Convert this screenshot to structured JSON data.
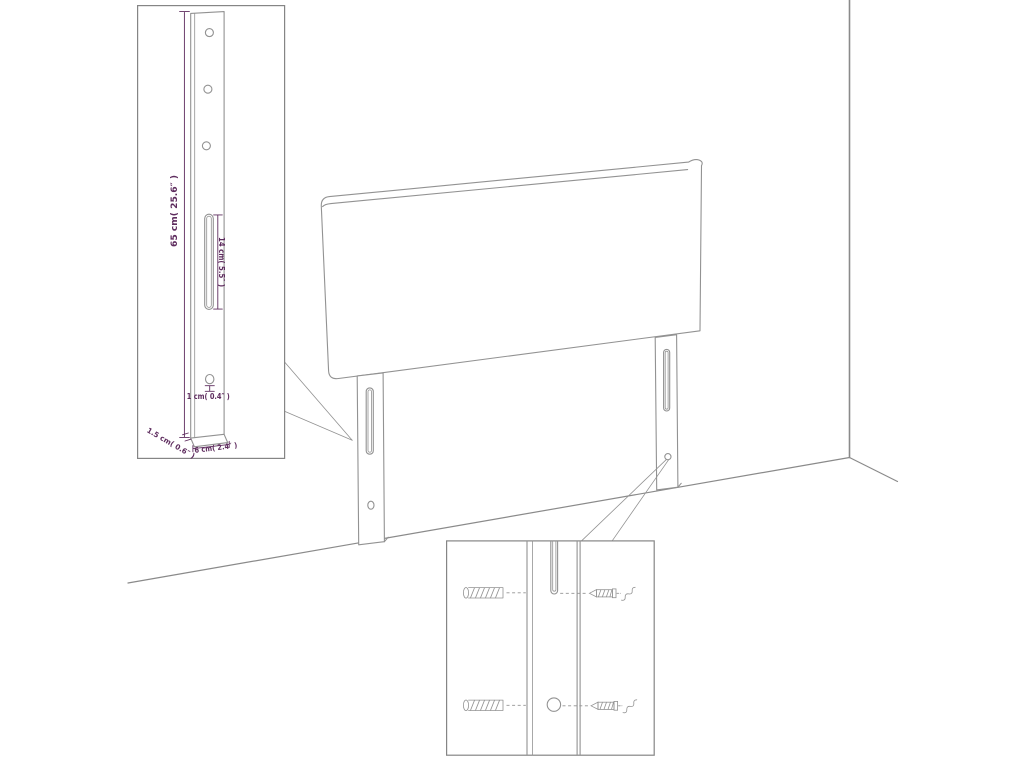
{
  "figure": {
    "type": "furniture-assembly-dimension-diagram"
  },
  "colors": {
    "line": "#929292",
    "corner": "#8a8a8a",
    "frame": "#858585",
    "dim": "#5e2c5e"
  },
  "labels": {
    "leg_height": "65 cm( 25.6″ )",
    "slot_length": "14 cm( 5.5″ )",
    "hole_diameter": "1 cm( 0.4″ )",
    "leg_depth": "1.5 cm( 0.6″ )",
    "leg_width": "6 cm( 2.4″ )"
  }
}
